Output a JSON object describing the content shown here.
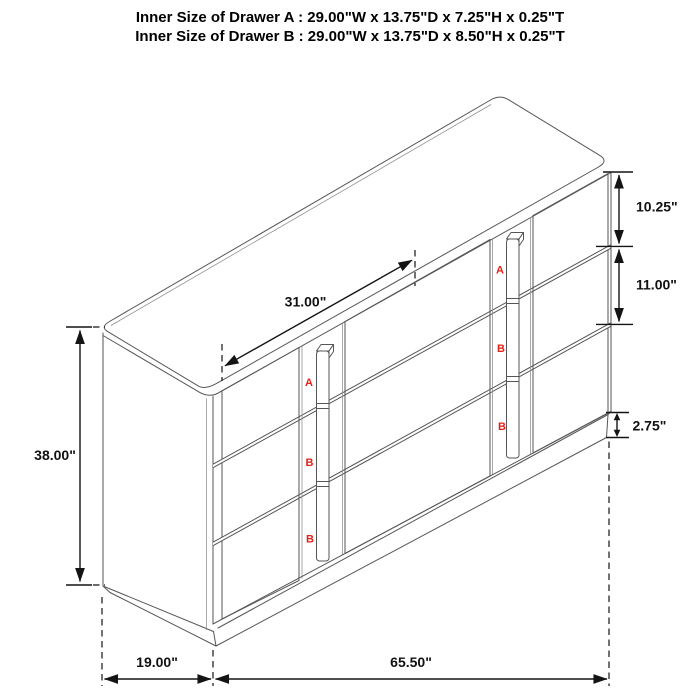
{
  "title": {
    "line1": "Inner Size of Drawer A : 29.00\"W x 13.75\"D x 7.25\"H x 0.25\"T",
    "line2": "Inner Size of Drawer B : 29.00\"W x 13.75\"D x 8.50\"H x 0.25\"T"
  },
  "dimensions": {
    "overall_height": "38.00\"",
    "overall_depth": "19.00\"",
    "overall_width": "65.50\"",
    "top_diagonal_span": "31.00\"",
    "drawer_a_front_height": "10.25\"",
    "drawer_b_front_height": "11.00\"",
    "base_height": "2.75\""
  },
  "drawer_labels": {
    "left_column": [
      "A",
      "B",
      "B"
    ],
    "right_column": [
      "A",
      "B",
      "B"
    ]
  },
  "colors": {
    "drawer_label_red": "#e32119",
    "dimension_black": "#141414",
    "furniture_line_gray": "#565656",
    "flute_gray": "#898989",
    "background": "#ffffff"
  }
}
